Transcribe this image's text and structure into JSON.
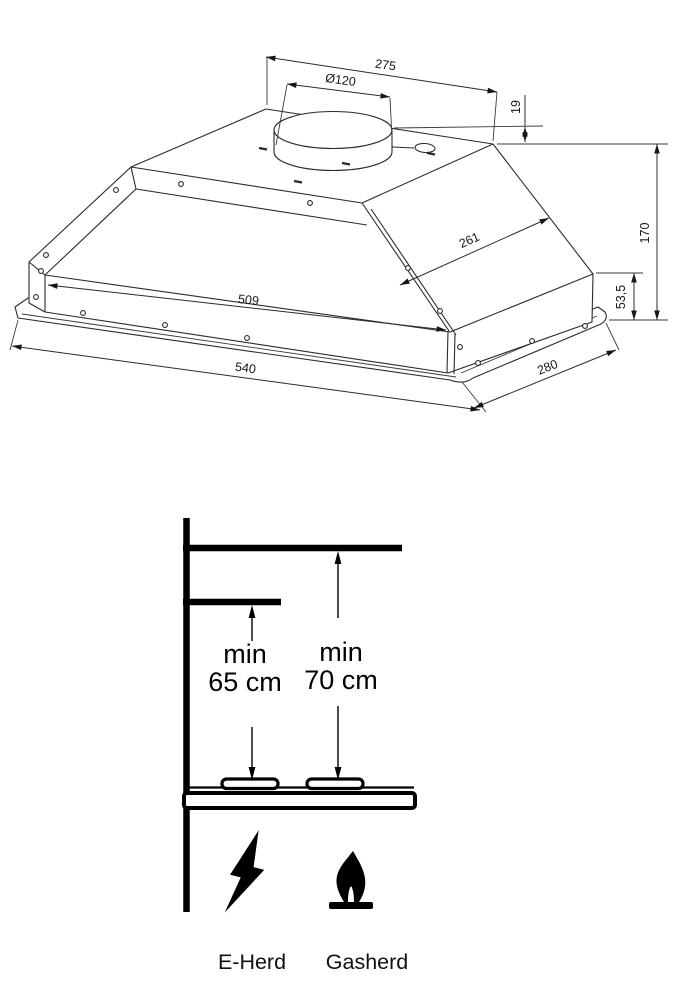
{
  "title": "Cooker hood dimensional and installation clearance drawing",
  "hood_drawing": {
    "dims": {
      "top_width": "275",
      "duct_diameter": "Ø120",
      "collar_height": "19",
      "slant_length": "261",
      "total_height": "170",
      "box_height": "53,5",
      "inner_width": "509",
      "overall_width": "540",
      "depth": "280"
    }
  },
  "clearance_drawing": {
    "electric_min_line1": "min",
    "electric_min_line2": "65 cm",
    "gas_min_line1": "min",
    "gas_min_line2": "70 cm",
    "electric_label": "E-Herd",
    "gas_label": "Gasherd"
  },
  "colors": {
    "background": "#ffffff",
    "line": "#2b2b2b",
    "thick_line": "#000000"
  }
}
